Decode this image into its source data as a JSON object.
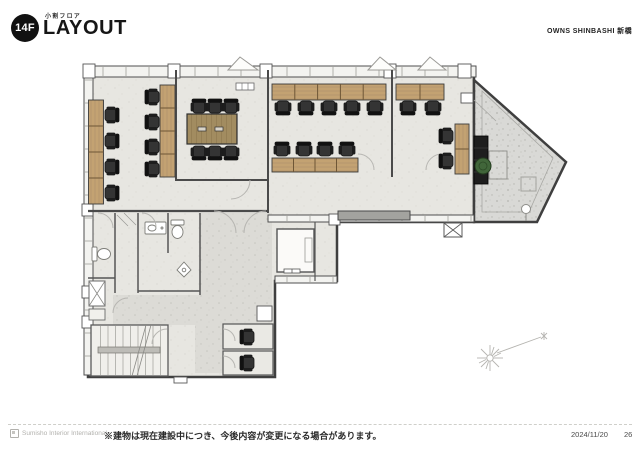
{
  "header": {
    "floor_badge": "14F",
    "subtitle": "小割フロア",
    "title": "LAYOUT",
    "building_name": "OWNS SHINBASHI 新橋"
  },
  "footer": {
    "company": "Sumisho Interior International",
    "note": "※建物は現在建設中につき、今後内容が変更になる場合があります。",
    "date": "2024/11/20",
    "page_number": "26"
  },
  "plan": {
    "icons": {
      "north_indicator": "compass-starburst-icon",
      "vent": "x-louver-icon",
      "plant": "plant-icon"
    },
    "colors": {
      "wall": "#4a4a4a",
      "floor": "#e7e6e1",
      "corridor": "#dcdbd6",
      "terrace": "#d9d9d6",
      "desk_wood": "#c9a87a",
      "table_wood": "#a28c60",
      "chair": "#2b2b2b",
      "counter": "#a3a39f",
      "plant_green": "#41663a"
    }
  }
}
